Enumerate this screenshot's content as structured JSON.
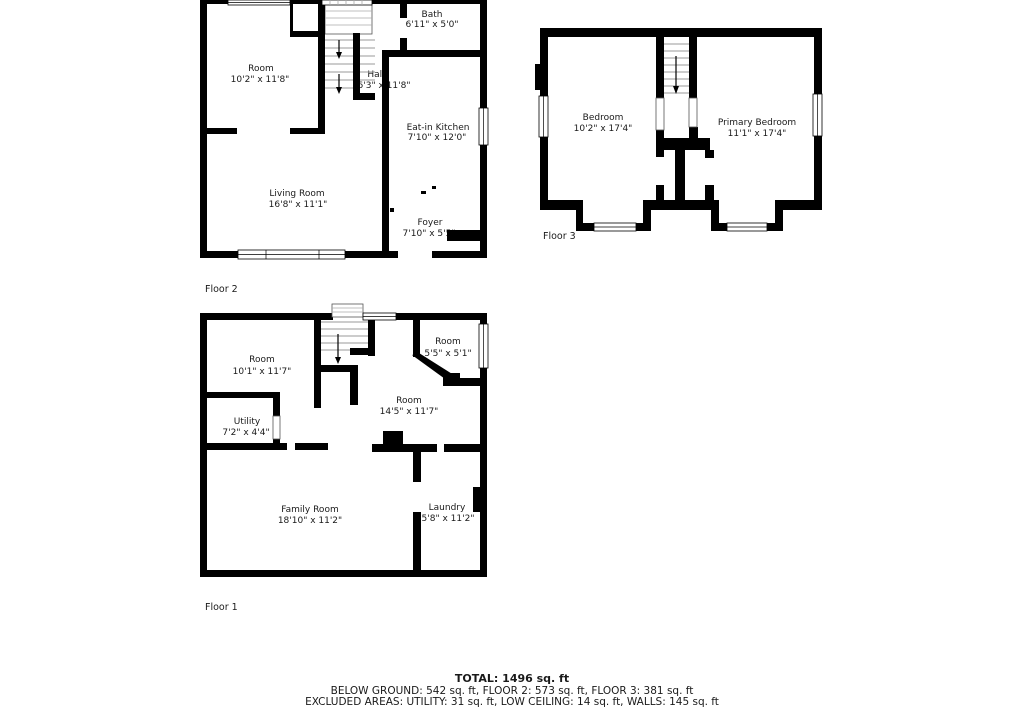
{
  "floor2": {
    "label": "Floor 2",
    "rooms": {
      "room": {
        "name": "Room",
        "dims": "10'2\" x 11'8\""
      },
      "bath": {
        "name": "Bath",
        "dims": "6'11\" x 5'0\""
      },
      "hall": {
        "name": "Hall",
        "dims": "6'3\" x 11'8\""
      },
      "kitchen": {
        "name": "Eat-in Kitchen",
        "dims": "7'10\" x 12'0\""
      },
      "living": {
        "name": "Living Room",
        "dims": "16'8\" x 11'1\""
      },
      "foyer": {
        "name": "Foyer",
        "dims": "7'10\" x 5'5\""
      }
    }
  },
  "floor3": {
    "label": "Floor 3",
    "rooms": {
      "bedroom": {
        "name": "Bedroom",
        "dims": "10'2\" x 17'4\""
      },
      "primary": {
        "name": "Primary Bedroom",
        "dims": "11'1\" x 17'4\""
      }
    }
  },
  "floor1": {
    "label": "Floor 1",
    "rooms": {
      "room_nw": {
        "name": "Room",
        "dims": "10'1\" x 11'7\""
      },
      "room_ne": {
        "name": "Room",
        "dims": "5'5\" x 5'1\""
      },
      "room_mid": {
        "name": "Room",
        "dims": "14'5\" x 11'7\""
      },
      "utility": {
        "name": "Utility",
        "dims": "7'2\" x 4'4\""
      },
      "family": {
        "name": "Family Room",
        "dims": "18'10\" x 11'2\""
      },
      "laundry": {
        "name": "Laundry",
        "dims": "5'8\" x 11'2\""
      }
    }
  },
  "summary": {
    "total": "TOTAL: 1496 sq. ft",
    "floors": "BELOW GROUND: 542 sq. ft, FLOOR 2: 573 sq. ft, FLOOR 3: 381 sq. ft",
    "excluded": "EXCLUDED AREAS: UTILITY: 31 sq. ft, LOW CEILING: 14 sq. ft, WALLS: 145 sq. ft"
  },
  "colors": {
    "wall": "#000000",
    "background": "#ffffff",
    "stair_lines": "#999999"
  }
}
